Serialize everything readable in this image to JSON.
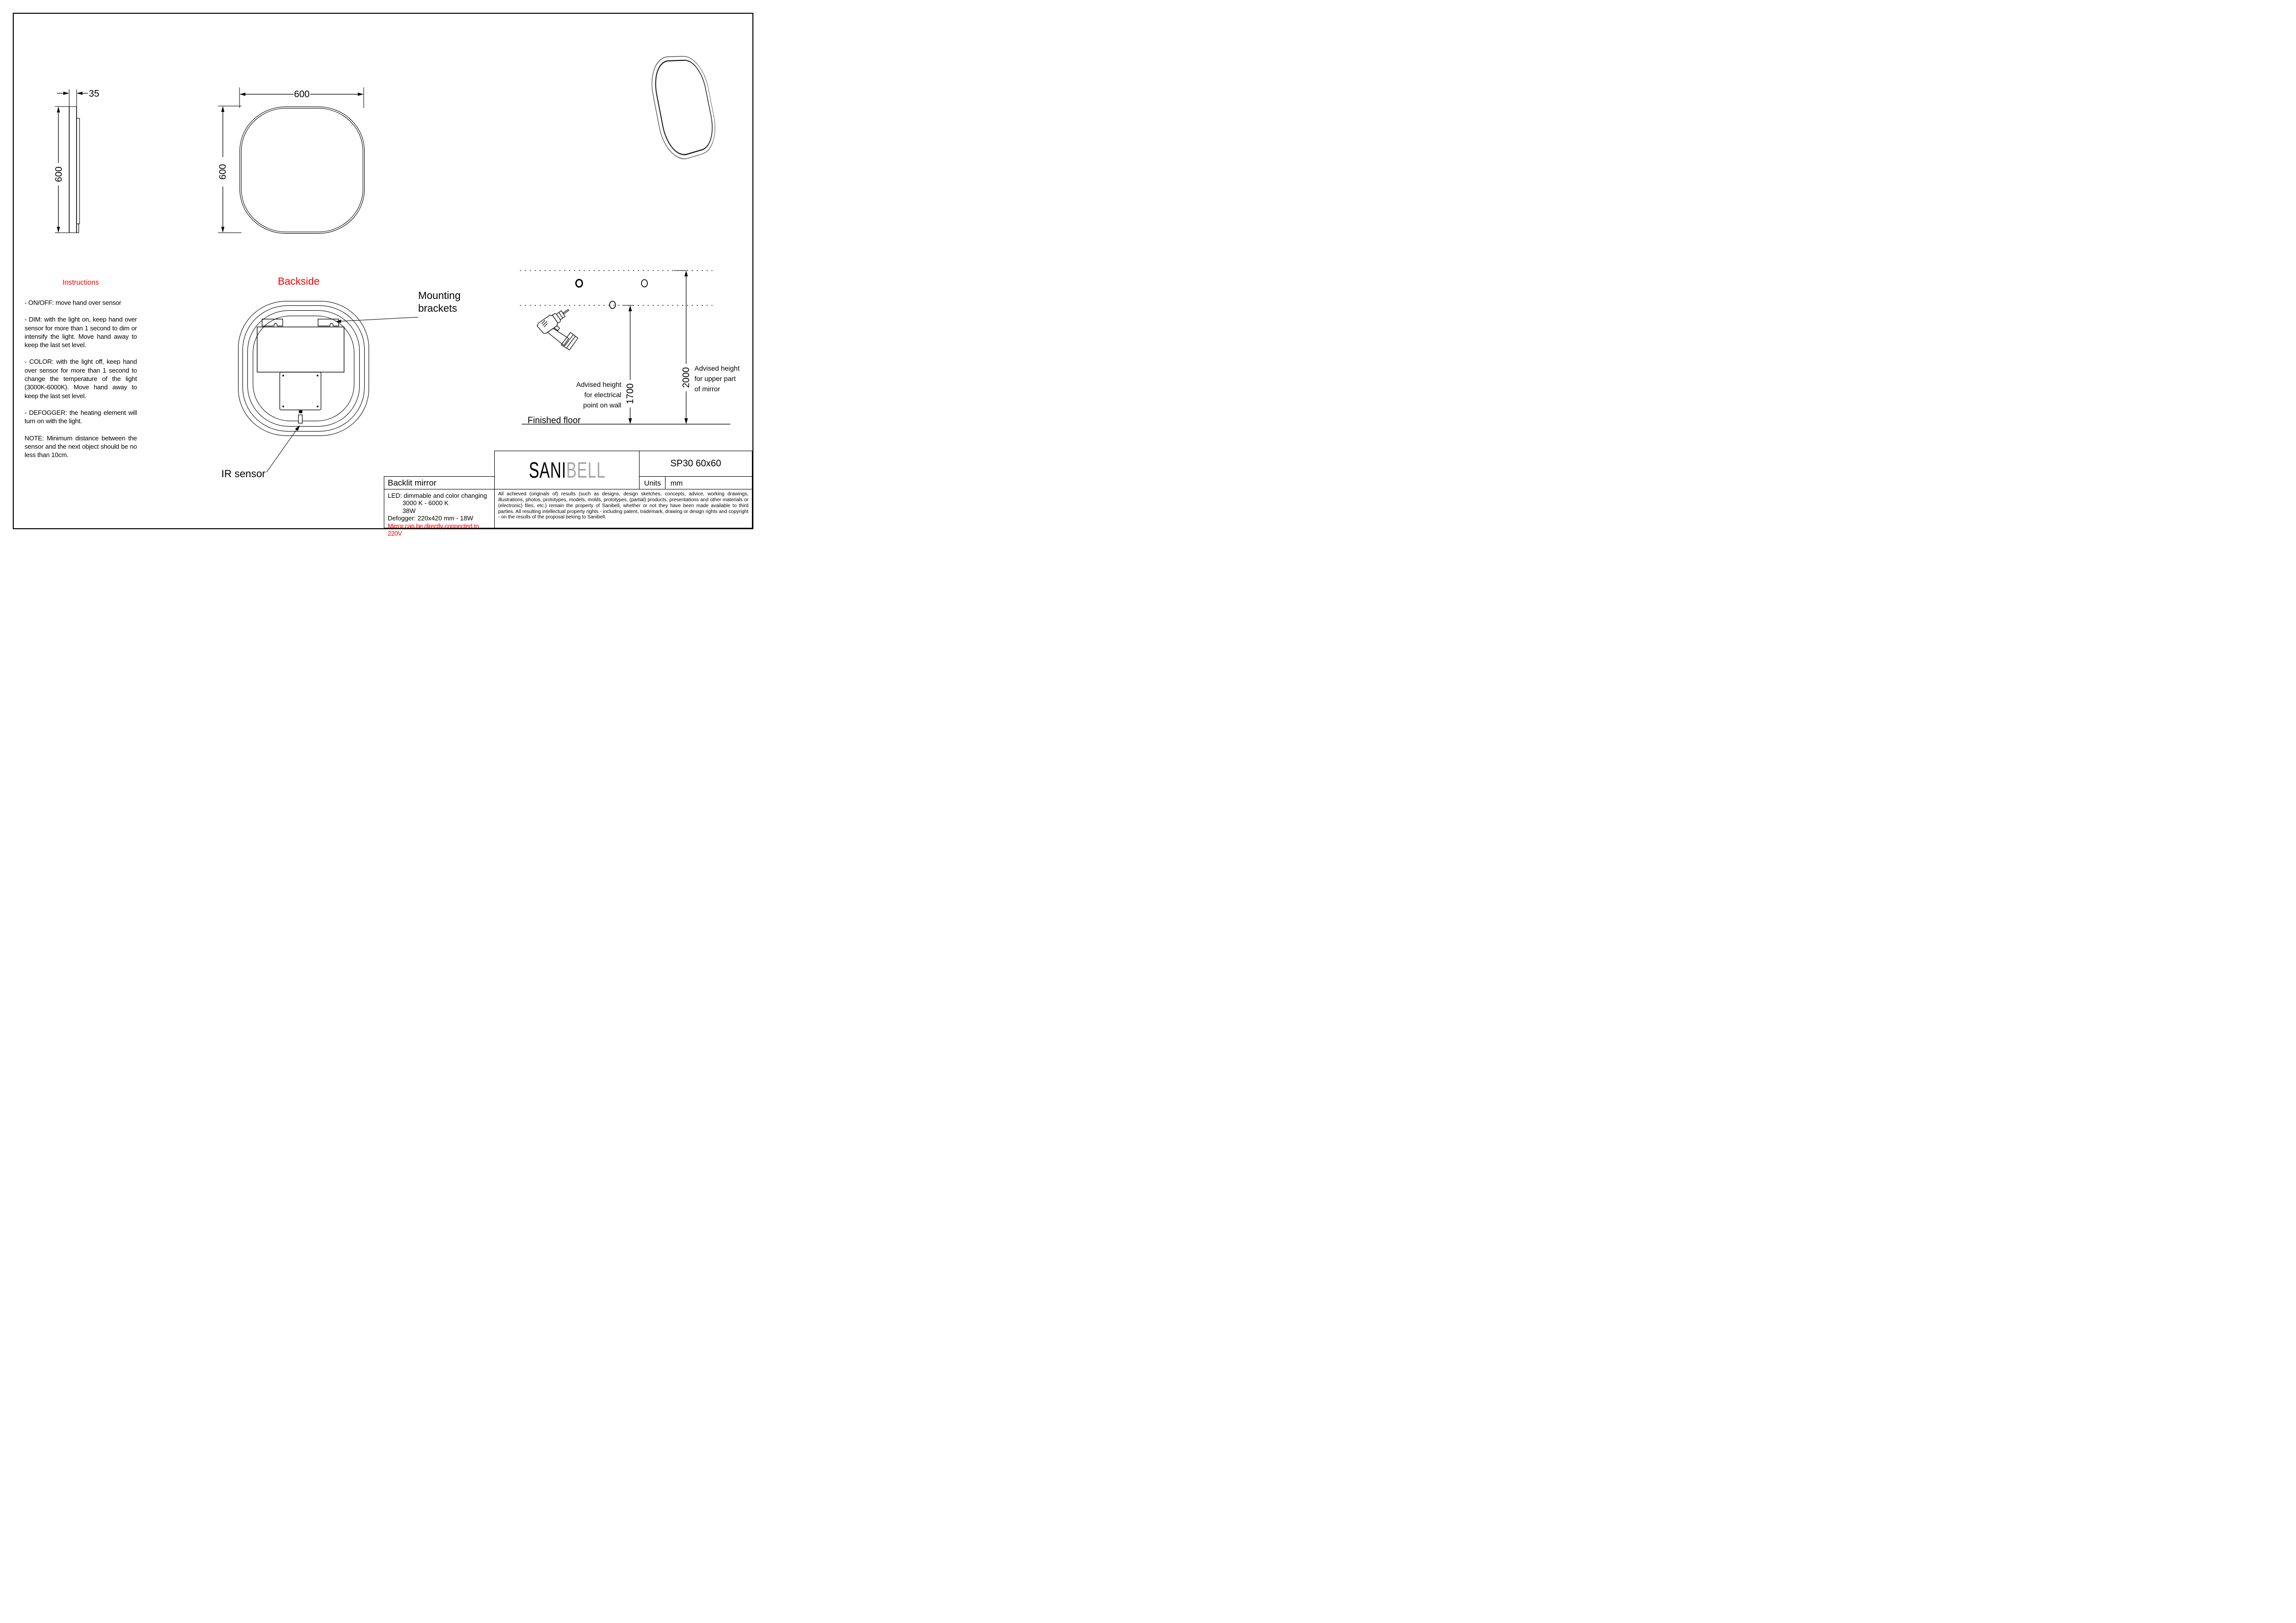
{
  "instructions": {
    "title": "Instructions",
    "paragraphs": [
      "- ON/OFF: move hand over sensor",
      "- DIM: with the light on, keep hand over sensor for more than 1 second to dim or intensify the light. Move hand away to keep the last set level.",
      "- COLOR: with the light off, keep hand over sensor for more than 1 second to change the temperature of the light (3000K-6000K). Move hand away to keep the last set level.",
      "- DEFOGGER: the heating element will turn on with the light.",
      "NOTE: Minimum distance between the sensor and the next object should be no less than 10cm."
    ]
  },
  "views": {
    "side": {
      "depth": "35",
      "height": "600"
    },
    "front": {
      "width": "600",
      "height": "600"
    },
    "backside": {
      "title": "Backside",
      "mounting_line1": "Mounting",
      "mounting_line2": "brackets",
      "ir_label": "IR sensor"
    }
  },
  "wall_mount": {
    "dim_electrical": "1700",
    "dim_mirror_top": "2000",
    "electrical_label": [
      "Advised height",
      "for electrical",
      "point on wall"
    ],
    "mirror_label": [
      "Advised height",
      "for upper part",
      "of mirror"
    ],
    "floor": "Finished floor"
  },
  "title_block": {
    "brand_black": "SANI",
    "brand_gray": "BELL",
    "model": "SP30 60x60",
    "units_label": "Units",
    "units_value": "mm",
    "product": "Backlit mirror",
    "spec_lines": [
      "LED: dimmable and color changing",
      "3000 K - 6000 K",
      "38W",
      "Defogger: 220x420 mm - 18W"
    ],
    "warning": "Mirror can be directly connected to 220V",
    "legal": "All achieved (originals of) results (such as designs, design sketches, concepts, advice, working drawings, illustrations, photos, prototypes, models, molds, prototypes, (partial) products, presentations and other materials or (electronic) files, etc.) remain the property of Sanibell, whether or not they have been made available to third parties. All resulting intellectual property rights - including patent, trademark, drawing or design rights and copyright - on the results of the proposal belong to Sanibell."
  },
  "colors": {
    "accent": "#f40000",
    "logo_gray": "#a9a9a9",
    "line": "#000000"
  }
}
